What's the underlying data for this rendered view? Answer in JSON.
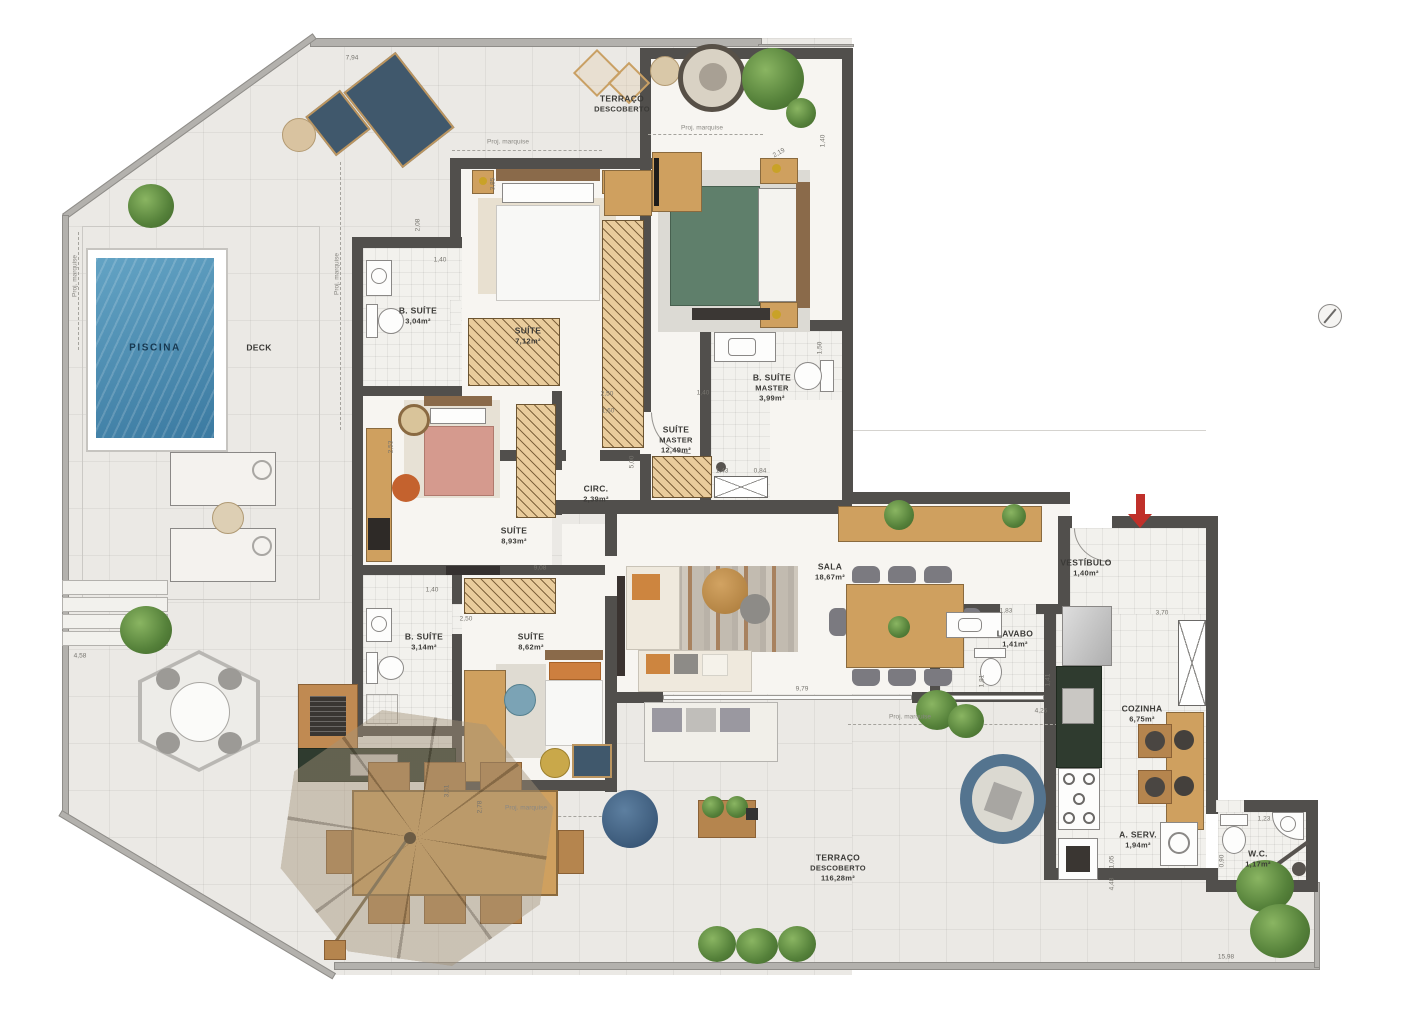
{
  "panel": {
    "title": "PENTHOUSE",
    "subtitle": "COM 4 SUÍTES",
    "area_value": "214,96 M",
    "area_sup": "2",
    "area_label": "DE ÁREA PRIVATIVA",
    "apartments": "APARTAMENTOS 1501 E 1504",
    "keyplan": {
      "units": [
        {
          "id": "1501",
          "highlight": "dark-red"
        },
        {
          "id": "1502",
          "highlight": "none"
        },
        {
          "id": "1503",
          "highlight": "none"
        },
        {
          "id": "1504",
          "highlight": "salmon"
        }
      ]
    },
    "colors": {
      "copper": "#b4714e",
      "unit_dark": "#9e2b20",
      "unit_light": "#c3887a"
    }
  },
  "plan": {
    "colors": {
      "wall": "#514f4c",
      "pool": "#4a8cb0",
      "arrow_red": "#c0302a"
    },
    "rooms": [
      {
        "lines": [
          "TERRAÇO",
          "DESCOBERTO"
        ],
        "x": 622,
        "y": 104
      },
      {
        "lines": [
          "PISCINA"
        ],
        "x": 155,
        "y": 348,
        "cls": "pool"
      },
      {
        "lines": [
          "DECK"
        ],
        "x": 259,
        "y": 348
      },
      {
        "lines": [
          "B. SUÍTE",
          "3,04m²"
        ],
        "x": 418,
        "y": 316
      },
      {
        "lines": [
          "SUÍTE",
          "7,12m²"
        ],
        "x": 528,
        "y": 336
      },
      {
        "lines": [
          "SUÍTE",
          "MASTER",
          "12,49m²"
        ],
        "x": 676,
        "y": 440
      },
      {
        "lines": [
          "B. SUÍTE",
          "MASTER",
          "3,99m²"
        ],
        "x": 772,
        "y": 388
      },
      {
        "lines": [
          "CIRC.",
          "2,39m²"
        ],
        "x": 596,
        "y": 494
      },
      {
        "lines": [
          "SUÍTE",
          "8,93m²"
        ],
        "x": 514,
        "y": 536
      },
      {
        "lines": [
          "B. SUÍTE",
          "3,14m²"
        ],
        "x": 424,
        "y": 642
      },
      {
        "lines": [
          "SUÍTE",
          "8,62m²"
        ],
        "x": 531,
        "y": 642
      },
      {
        "lines": [
          "SALA",
          "18,67m²"
        ],
        "x": 830,
        "y": 572
      },
      {
        "lines": [
          "VESTÍBULO",
          "1,40m²"
        ],
        "x": 1086,
        "y": 568
      },
      {
        "lines": [
          "LAVABO",
          "1,41m²"
        ],
        "x": 1015,
        "y": 639
      },
      {
        "lines": [
          "COZINHA",
          "6,75m²"
        ],
        "x": 1142,
        "y": 714
      },
      {
        "lines": [
          "A. SERV.",
          "1,94m²"
        ],
        "x": 1138,
        "y": 840
      },
      {
        "lines": [
          "W.C.",
          "1,17m²"
        ],
        "x": 1258,
        "y": 859
      },
      {
        "lines": [
          "TERRAÇO",
          "DESCOBERTO",
          "116,28m²"
        ],
        "x": 838,
        "y": 868
      }
    ],
    "dims": [
      {
        "t": "7,94",
        "x": 352,
        "y": 58,
        "r": 0
      },
      {
        "t": "3,85",
        "x": 493,
        "y": 184,
        "r": -90
      },
      {
        "t": "2,08",
        "x": 418,
        "y": 225,
        "r": -90
      },
      {
        "t": "1,40",
        "x": 440,
        "y": 260,
        "r": 0
      },
      {
        "t": "2,19",
        "x": 779,
        "y": 153,
        "r": -30
      },
      {
        "t": "1,40",
        "x": 823,
        "y": 141,
        "r": -90
      },
      {
        "t": "1,50",
        "x": 820,
        "y": 348,
        "r": -90
      },
      {
        "t": "2,50",
        "x": 607,
        "y": 394,
        "r": 0
      },
      {
        "t": "1,60",
        "x": 608,
        "y": 411,
        "r": 0
      },
      {
        "t": "1,40",
        "x": 703,
        "y": 393,
        "r": 0
      },
      {
        "t": "5,00",
        "x": 632,
        "y": 462,
        "r": -90
      },
      {
        "t": "2,53",
        "x": 391,
        "y": 447,
        "r": -90
      },
      {
        "t": "1,43",
        "x": 722,
        "y": 471,
        "r": 0
      },
      {
        "t": "0,84",
        "x": 760,
        "y": 471,
        "r": 0
      },
      {
        "t": "9,08",
        "x": 540,
        "y": 568,
        "r": 0
      },
      {
        "t": "1,40",
        "x": 432,
        "y": 590,
        "r": 0
      },
      {
        "t": "2,50",
        "x": 466,
        "y": 619,
        "r": 0
      },
      {
        "t": "4,58",
        "x": 80,
        "y": 656,
        "r": 0
      },
      {
        "t": "3,51",
        "x": 447,
        "y": 791,
        "r": -90
      },
      {
        "t": "2,78",
        "x": 480,
        "y": 807,
        "r": -90
      },
      {
        "t": "9,79",
        "x": 802,
        "y": 689,
        "r": 0
      },
      {
        "t": "1,83",
        "x": 1006,
        "y": 611,
        "r": 0
      },
      {
        "t": "3,70",
        "x": 1162,
        "y": 613,
        "r": 0
      },
      {
        "t": "1,81",
        "x": 982,
        "y": 681,
        "r": -90
      },
      {
        "t": "1,41",
        "x": 1048,
        "y": 680,
        "r": -90
      },
      {
        "t": "4,26",
        "x": 1041,
        "y": 711,
        "r": 0
      },
      {
        "t": "1,05",
        "x": 1112,
        "y": 862,
        "r": -90
      },
      {
        "t": "4,48",
        "x": 1112,
        "y": 884,
        "r": -90
      },
      {
        "t": "0,90",
        "x": 1222,
        "y": 861,
        "r": -90
      },
      {
        "t": "1,23",
        "x": 1264,
        "y": 819,
        "r": 0
      },
      {
        "t": "15,98",
        "x": 1226,
        "y": 957,
        "r": 0
      }
    ],
    "marquise": {
      "text": "Proj. marquise",
      "items": [
        {
          "x": 508,
          "y": 142,
          "r": 0
        },
        {
          "x": 702,
          "y": 128,
          "r": 0
        },
        {
          "x": 337,
          "y": 274,
          "r": -90
        },
        {
          "x": 75,
          "y": 276,
          "r": -90
        },
        {
          "x": 910,
          "y": 717,
          "r": 0
        },
        {
          "x": 526,
          "y": 808,
          "r": 0
        }
      ]
    }
  }
}
